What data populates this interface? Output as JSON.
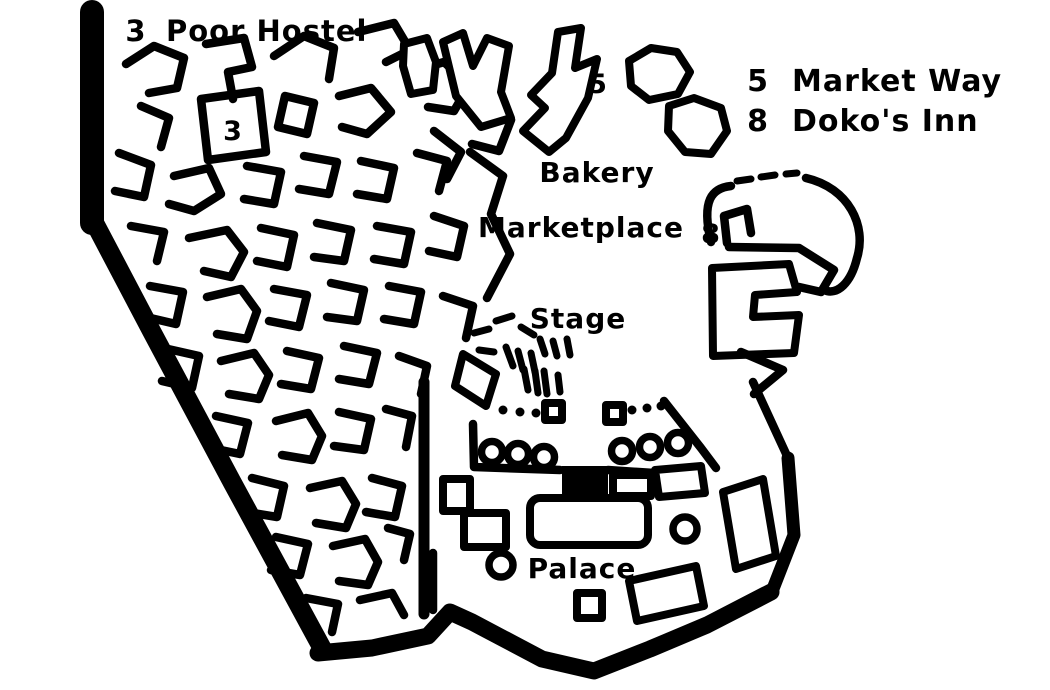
{
  "colors": {
    "ink": "#000000",
    "paper": "#ffffff"
  },
  "legend": {
    "top_left": {
      "num": "3",
      "label": "Poor Hostel"
    },
    "top_right": [
      {
        "num": "5",
        "label": "Market Way"
      },
      {
        "num": "8",
        "label": "Doko's Inn"
      }
    ]
  },
  "map": {
    "labels": {
      "bakery": "Bakery",
      "marketplace": "Marketplace",
      "stage": "Stage",
      "palace": "Palace"
    },
    "markers": {
      "poor_hostel": "3",
      "market_way": "5",
      "dokos_inn": "8"
    }
  }
}
